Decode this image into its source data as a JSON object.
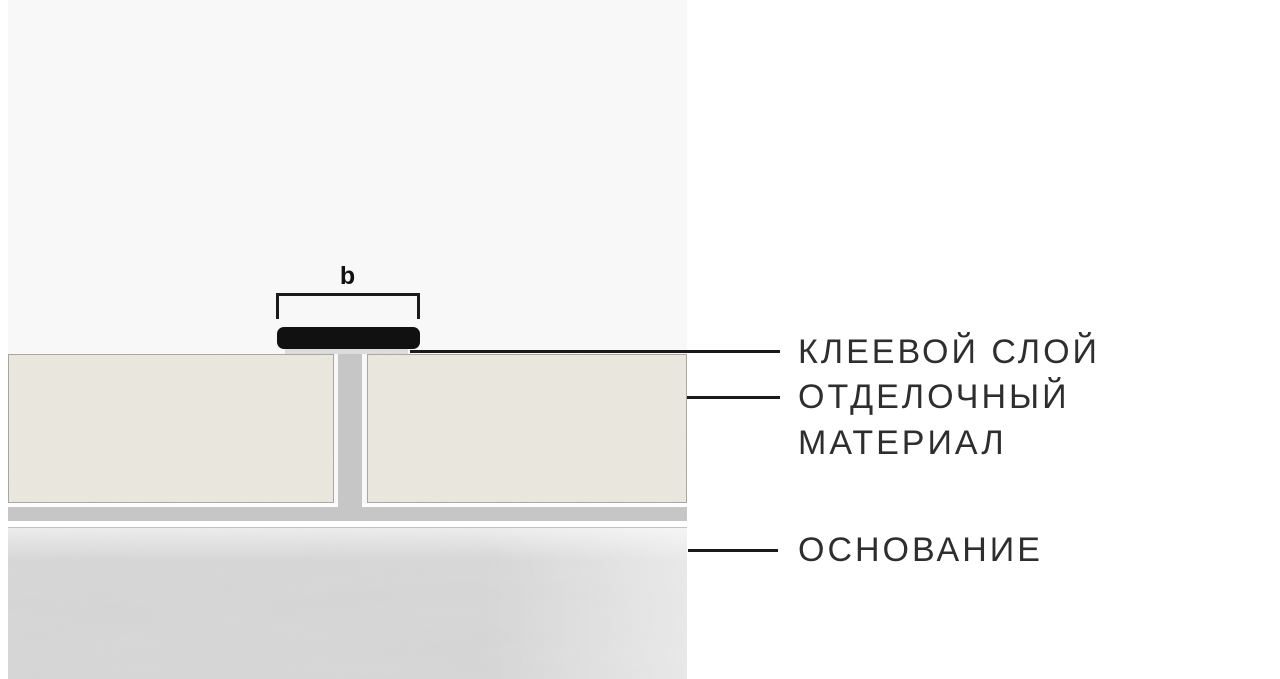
{
  "diagram": {
    "dimension_label": "b",
    "labels": {
      "adhesive_layer": "КЛЕЕВОЙ СЛОЙ",
      "finishing_material_line1": "ОТДЕЛОЧНЫЙ",
      "finishing_material_line2": "МАТЕРИАЛ",
      "substrate": "ОСНОВАНИЕ"
    },
    "colors": {
      "page_bg": "#ffffff",
      "panel_bg": "#f8f8f8",
      "profile_black": "#111111",
      "joint_gray": "#c6c6c6",
      "adhesive_under_cap_gray": "#dcdcdc",
      "tile_fill": "#ece9e0",
      "tile_border": "#a9a7a1",
      "substrate_gray": "#d9d9d9",
      "line_color": "#1a1a1a",
      "text_color": "#2e2e2e"
    }
  }
}
